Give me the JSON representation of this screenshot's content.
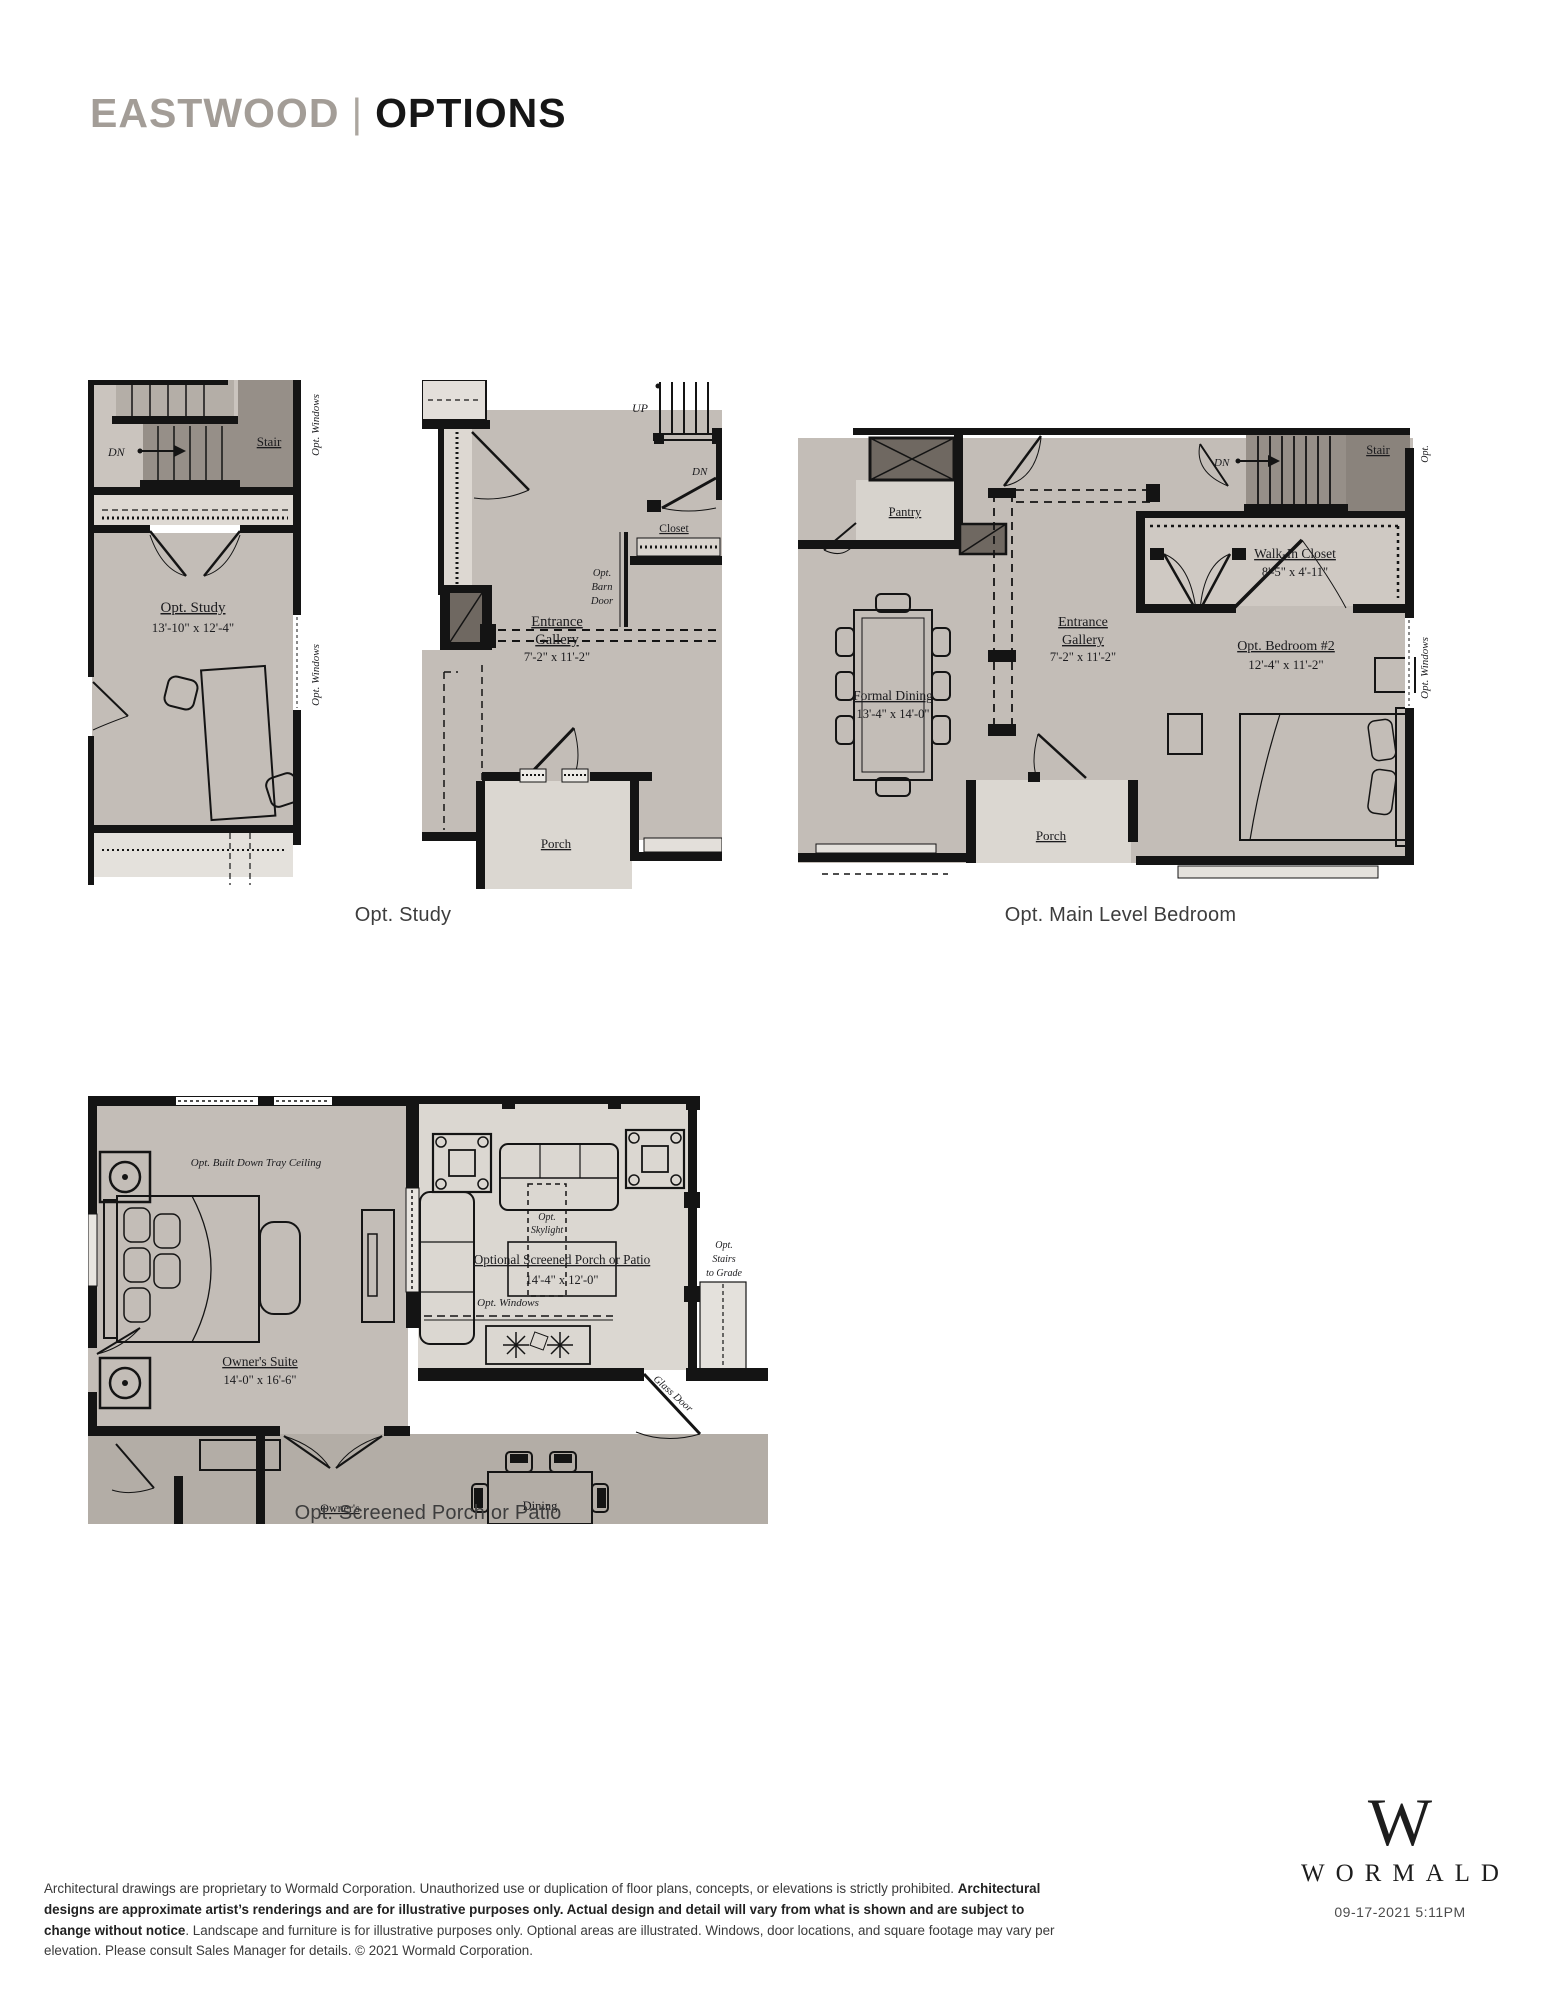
{
  "header": {
    "project_name": "EASTWOOD",
    "divider": "|",
    "page_title": "OPTIONS"
  },
  "captions": {
    "study": "Opt. Study",
    "main_level_bedroom": "Opt. Main Level Bedroom",
    "screened_porch": "Opt. Screened Porch or Patio"
  },
  "plan_study": {
    "dn": "DN",
    "stair": "Stair",
    "room": "Opt. Study",
    "dims": "13'-10\" x 12'-4\"",
    "opt_windows_upper": "Opt. Windows",
    "opt_windows_lower": "Opt. Windows"
  },
  "plan_gallery": {
    "up": "UP",
    "dn": "DN",
    "closet": "Closet",
    "barn_door_1": "Opt.",
    "barn_door_2": "Barn",
    "barn_door_3": "Door",
    "room_1": "Entrance",
    "room_2": "Gallery",
    "dims": "7'-2\" x 11'-2\"",
    "porch": "Porch"
  },
  "plan_bedroom": {
    "pantry": "Pantry",
    "dining": "Formal Dining",
    "dining_dims": "13'-4\" x 14'-0\"",
    "gallery_1": "Entrance",
    "gallery_2": "Gallery",
    "gallery_dims": "7'-2\" x 11'-2\"",
    "dn": "DN",
    "stair": "Stair",
    "opt_edge": "Opt.",
    "wic": "Walk-In Closet",
    "wic_dims": "8'-5\" x 4'-11\"",
    "bedroom": "Opt. Bedroom #2",
    "bedroom_dims": "12'-4\" x 11'-2\"",
    "porch": "Porch",
    "opt_windows": "Opt. Windows"
  },
  "plan_porch": {
    "tray_ceiling": "Opt. Built Down Tray Ceiling",
    "suite": "Owner's Suite",
    "suite_dims": "14'-0\" x 16'-6\"",
    "owners_cut": "Owner's",
    "skylight_1": "Opt.",
    "skylight_2": "Skylight",
    "title": "Optional Screened Porch or Patio",
    "title_dims": "14'-4\" x 12'-0\"",
    "opt_windows": "Opt. Windows",
    "stairs_1": "Opt.",
    "stairs_2": "Stairs",
    "stairs_3": "to Grade",
    "glass_door": "Glass Door",
    "dining": "Dining"
  },
  "footer": {
    "text_1": "Architectural drawings are proprietary to Wormald Corporation. Unauthorized use or duplication of floor plans, concepts, or elevations is strictly prohibited. ",
    "text_bold": "Architectural designs are approximate artist’s renderings and are for illustrative purposes only. Actual design and detail will vary from what is shown and are subject to change without notice",
    "text_2": ". Landscape and furniture is for illustrative purposes only. Optional areas are illustrated. Windows, door locations, and square footage may vary per elevation. Please consult Sales Manager for details. © 2021 Wormald Corporation."
  },
  "brand": {
    "monogram": "W",
    "wordmark": "WORMALD",
    "timestamp": "09-17-2021 5:11PM"
  },
  "colors": {
    "wall": "#141414",
    "room": "#c3bdb7",
    "hall": "#d9d5cf",
    "porch": "#dbd7d1",
    "stair": "#968f88",
    "shaft": "#6f6861",
    "great_room": "#b3ada6",
    "title_gray": "#a39d97"
  }
}
